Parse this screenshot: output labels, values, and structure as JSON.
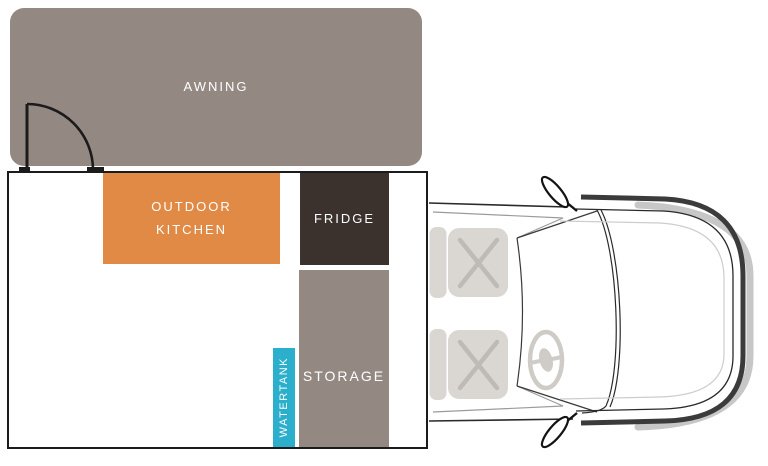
{
  "floorplan": {
    "awning": {
      "label": "AWNING",
      "color": "#948883"
    },
    "outdoor_kitchen": {
      "label": "OUTDOOR\nKITCHEN",
      "color": "#E08A45"
    },
    "fridge": {
      "label": "FRIDGE",
      "color": "#3B322D"
    },
    "storage": {
      "label": "STORAGE",
      "color": "#948883"
    },
    "watertank": {
      "label": "WATERTANK",
      "color": "#2BAFCC"
    },
    "label_color": "#FFFFFF",
    "body_outline_color": "#1B1B1B",
    "door_color": "#1B1B1B"
  },
  "vehicle": {
    "chassis_line_color": "#2A2A2A",
    "cab_line_color": "#9B9B9B",
    "pillar_line_color": "#3A3A3A",
    "bumper_color": "#3B3B3B",
    "bumper_shadow_color": "#C7C7C7",
    "hood_inner_line_color": "#CDCDCD",
    "seat_fill": "#DAD7D3",
    "seat_cross_color": "#BEBAB5",
    "steering_wheel_color": "#CFCBC6",
    "mirror_outline": "#141414"
  }
}
